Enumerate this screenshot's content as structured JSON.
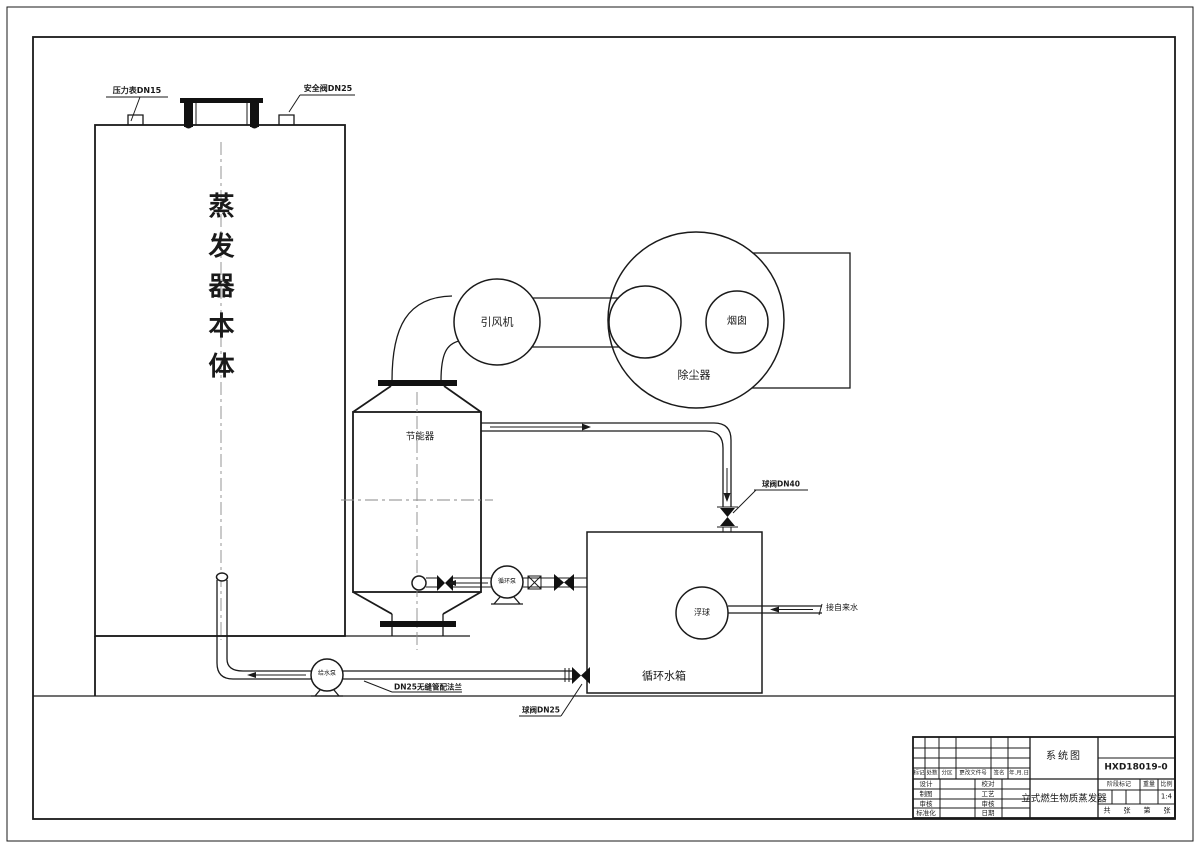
{
  "drawing": {
    "equipment_labels": {
      "pressure_gauge": "压力表DN15",
      "safety_valve": "安全阀DN25",
      "evaporator_body": "蒸发器本体",
      "induced_draft_fan": "引风机",
      "dust_collector": "除尘器",
      "chimney": "烟囱",
      "economizer": "节能器",
      "circulation_pump": "循环泵",
      "feed_pump": "给水泵",
      "circulating_water_tank": "循环水箱",
      "float_ball": "浮球",
      "tap_water_inlet": "接自来水",
      "ball_valve_dn40": "球阀DN40",
      "ball_valve_dn25": "球阀DN25",
      "seamless_pipe_note": "DN25无缝管配法兰"
    },
    "title_block": {
      "view_name": "系统图",
      "drawing_number": "HXD18019-0",
      "drawing_title": "立式燃生物质蒸发器",
      "revision_headers": [
        "标记",
        "处数",
        "分区",
        "更改文件号",
        "签名",
        "年.月.日"
      ],
      "signature_rows_left": [
        "设计",
        "制图",
        "审核",
        "标准化"
      ],
      "signature_rows_right": [
        "校对",
        "工艺",
        "审核",
        "日期"
      ],
      "stage_mark_label": "阶段标记",
      "weight_label": "重量",
      "scale_label": "比例",
      "scale_value": "1:4",
      "sheet_labels": [
        "共",
        "张",
        "第",
        "张"
      ]
    }
  }
}
